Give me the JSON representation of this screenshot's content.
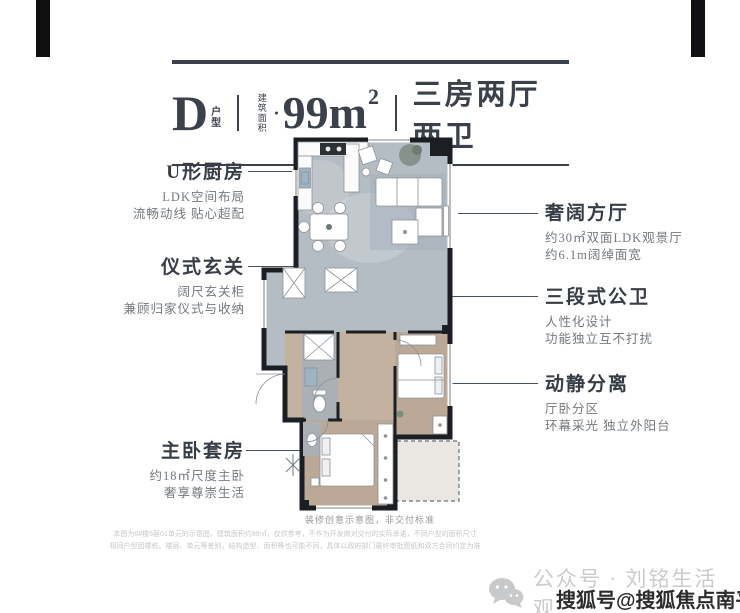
{
  "header": {
    "unit_letter": "D",
    "unit_stack_top": "户",
    "unit_stack_bottom": "型",
    "area_stack_top": "建筑",
    "area_stack_bottom": "面积",
    "area_bullet": "●",
    "area_value": "99m",
    "area_sup": "2",
    "layout": "三房两厅两卫"
  },
  "annotations_left": [
    {
      "title": "U形厨房",
      "lines": [
        "LDK空间布局",
        "流畅动线 贴心超配"
      ]
    },
    {
      "title": "仪式玄关",
      "lines": [
        "阔尺玄关柜",
        "兼顾归家仪式与收纳"
      ]
    },
    {
      "title": "主卧套房",
      "lines": [
        "约18㎡尺度主卧",
        "奢享尊崇生活"
      ]
    }
  ],
  "annotations_right": [
    {
      "title": "奢阔方厅",
      "lines": [
        "约30㎡双面LDK观景厅",
        "约6.1m阔绰面宽"
      ]
    },
    {
      "title": "三段式公卫",
      "lines": [
        "人性化设计",
        "功能独立互不打扰"
      ]
    },
    {
      "title": "动静分离",
      "lines": [
        "厅卧分区",
        "环幕采光 独立外阳台"
      ]
    }
  ],
  "footer": {
    "note": "装修创意示意图，非交付标准",
    "disclaimer1": "本图为6#楼5层01单元的示意图，建筑面积约99㎡，仅供参考，不作为开发商对交付的实际承诺，不同户型的面积尺寸",
    "disclaimer2": "相同户型因楼栋、楼层、单元等差别，结构造型、面积等也可能不同，具体以政府部门最终审批图纸和双方合同约定为准",
    "wechat_text": "公众号 · 刘铭生活观",
    "sohu_watermark": "搜狐号@搜狐焦点南平站"
  },
  "colors": {
    "ink": "#3a414a",
    "leader_line": "#46525e",
    "description_gray": "#73797e",
    "watermark_gray": "#c9cbcd",
    "wall_black": "#1b1e23",
    "living_floor": "#b5bdc4",
    "bedroom_floor": "#bba896"
  }
}
